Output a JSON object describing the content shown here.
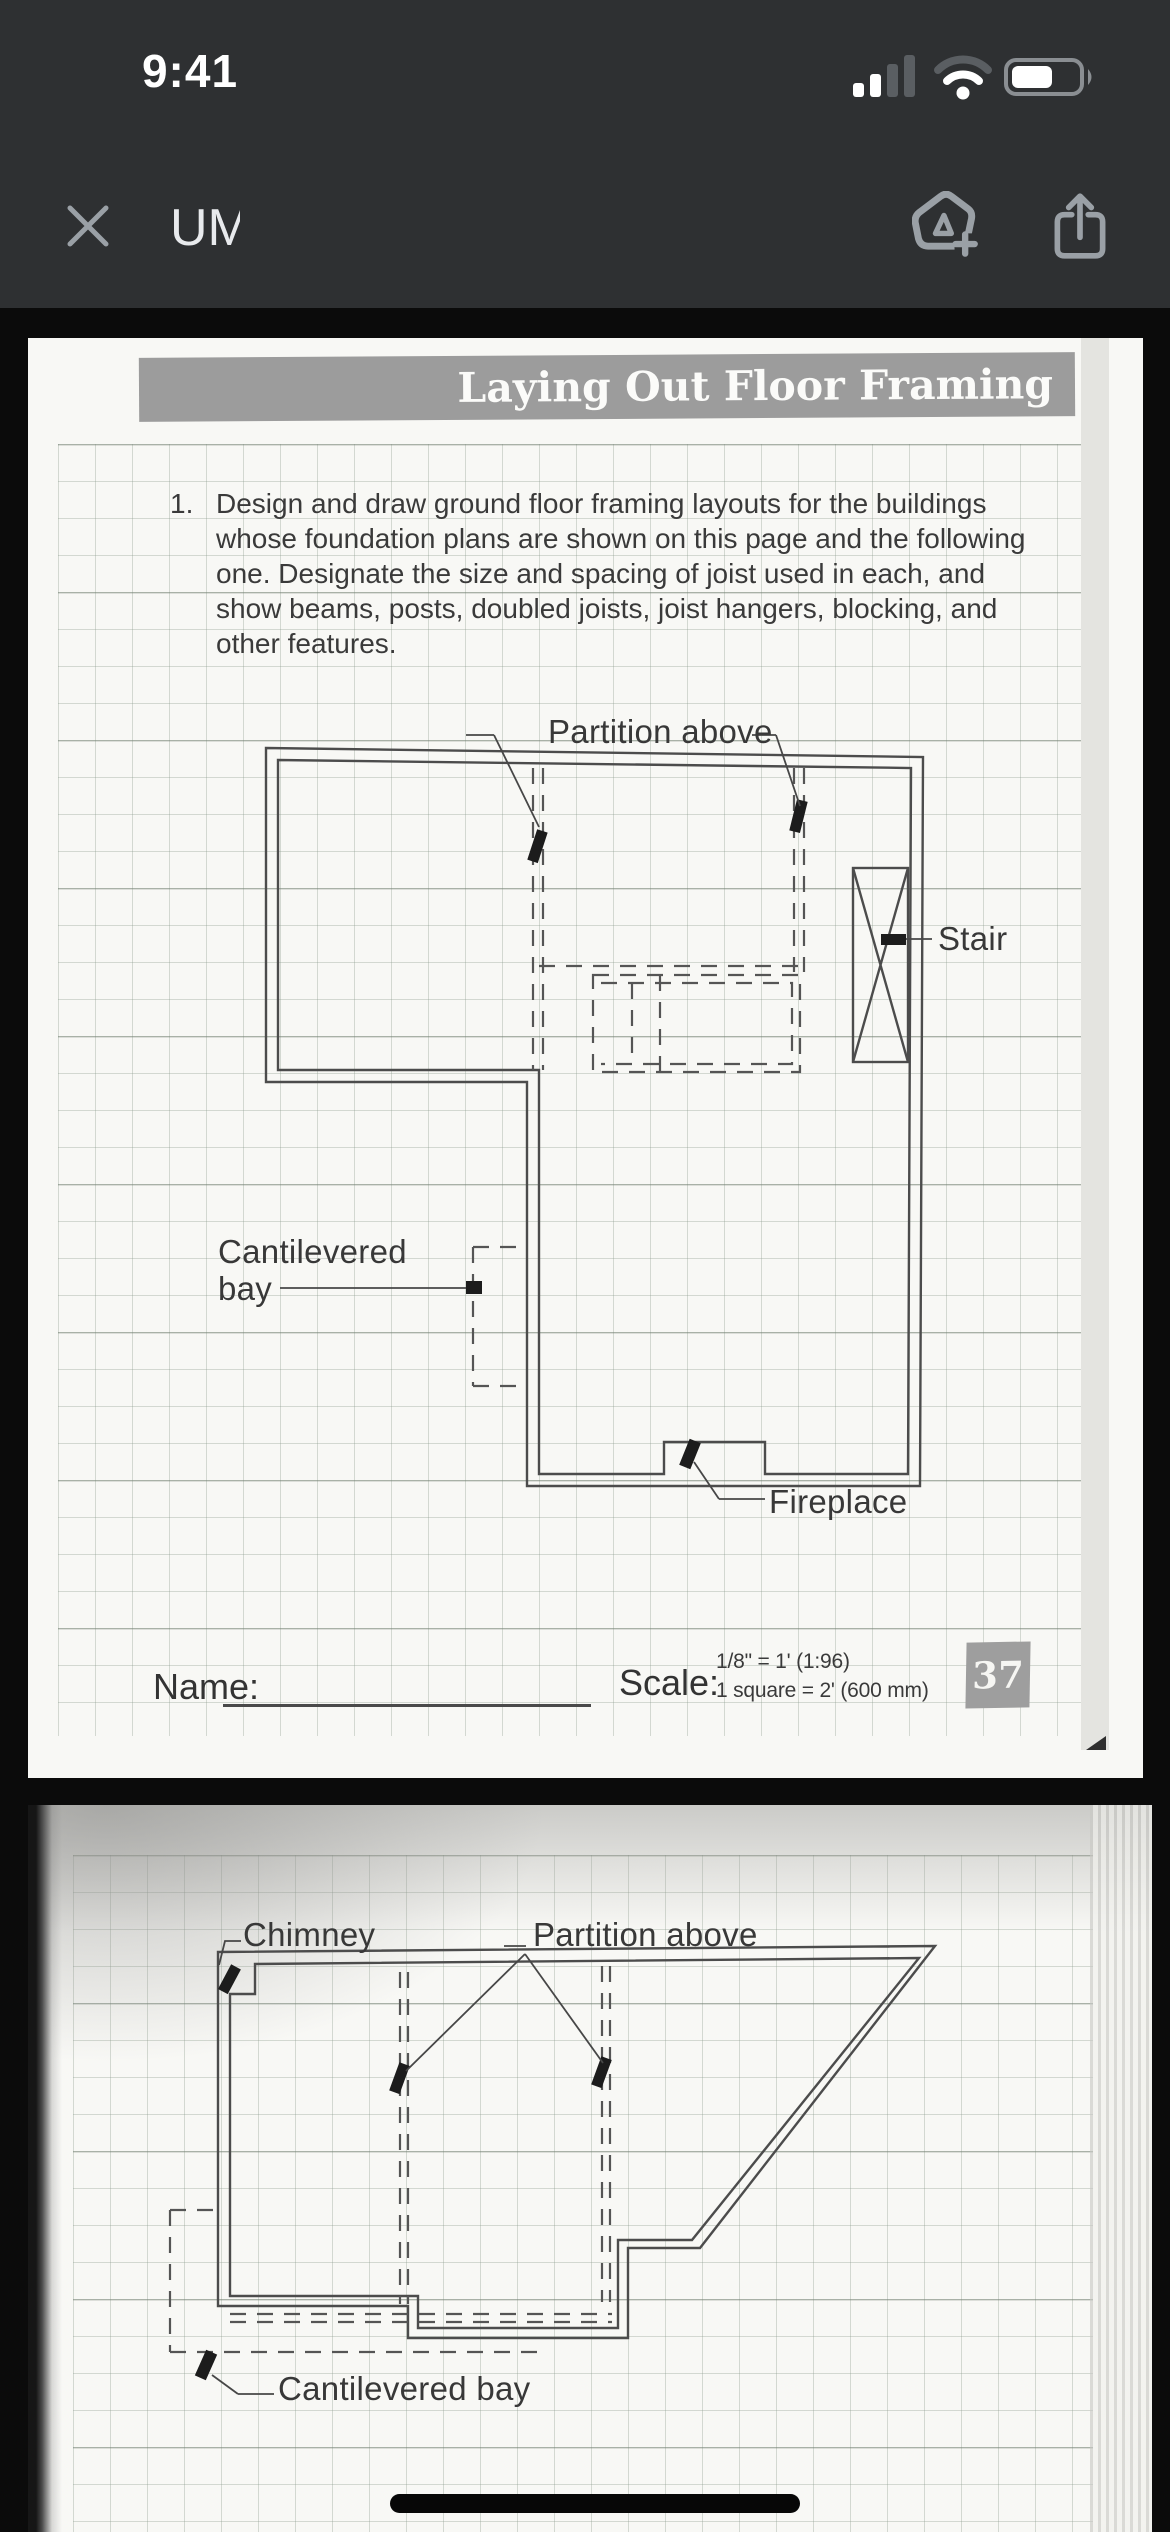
{
  "status_bar": {
    "time": "9:41",
    "cellular_bars_active": 2,
    "cellular_bars_total": 4,
    "battery_percent_visual": 55
  },
  "toolbar": {
    "title": "UMESCANON_Dept o..."
  },
  "icons": {
    "close": "close-icon",
    "markup": "markup-pen-plus-icon",
    "share": "share-icon",
    "cellular": "cellular-signal-icon",
    "wifi": "wifi-icon",
    "battery": "battery-icon",
    "home": "home-indicator"
  },
  "page1": {
    "banner": "Laying Out Floor Framing",
    "instruction": {
      "number": "1.",
      "lines": [
        "Design and draw ground floor framing layouts for the buildings",
        "whose foundation plans are shown on this page and the following",
        "one. Designate the size and spacing of joist used in each, and",
        "show beams, posts, doubled joists, joist hangers, blocking, and",
        "other features."
      ]
    },
    "labels": {
      "partition_above": "Partition above",
      "stair": "Stair",
      "cantilevered_line1": "Cantilevered",
      "cantilevered_line2": "bay",
      "fireplace": "Fireplace"
    },
    "footer": {
      "name_label": "Name:",
      "scale_label": "Scale:",
      "scale_line1": "1/8\" = 1' (1:96)",
      "scale_line2": "1 square = 2' (600 mm)",
      "page_number": "37"
    }
  },
  "page2": {
    "labels": {
      "chimney": "Chimney",
      "partition_above": "Partition above",
      "cantilevered_bay": "Cantilevered bay"
    }
  },
  "colors": {
    "toolbar_bg": "#2e3032",
    "icon_gray": "#9aa0a6",
    "page_bg": "#f8f8f5",
    "banner_bg": "#9c9c9c",
    "plan_line": "#4c4c4c",
    "badge_bg": "#9e9e9e"
  }
}
